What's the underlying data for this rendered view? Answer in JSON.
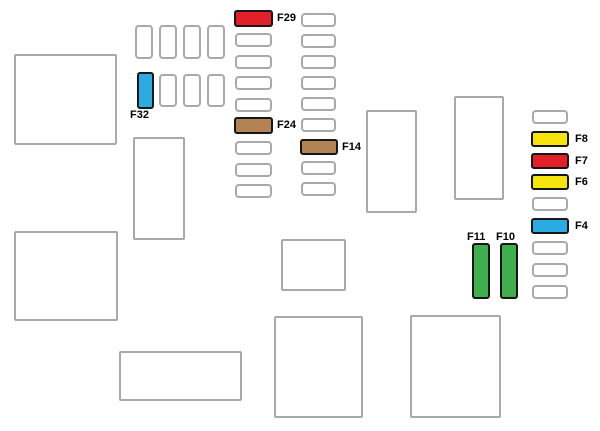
{
  "diagram_type": "fuse-box-diagram",
  "colors": {
    "red": "#e32028",
    "yellow": "#f5e50c",
    "blue": "#2aabe2",
    "brown": "#b28354",
    "green": "#3fae4d",
    "slot_border": "#a9a9a9",
    "highlight_border": "#161616",
    "label": "#000000"
  },
  "fuses": {
    "f29": {
      "label": "F29",
      "color": "red"
    },
    "f32": {
      "label": "F32",
      "color": "blue"
    },
    "f24": {
      "label": "F24",
      "color": "brown"
    },
    "f14": {
      "label": "F14",
      "color": "brown"
    },
    "f8": {
      "label": "F8",
      "color": "yellow"
    },
    "f7": {
      "label": "F7",
      "color": "red"
    },
    "f6": {
      "label": "F6",
      "color": "yellow"
    },
    "f4": {
      "label": "F4",
      "color": "blue"
    },
    "f11": {
      "label": "F11",
      "color": "green"
    },
    "f10": {
      "label": "F10",
      "color": "green"
    }
  }
}
